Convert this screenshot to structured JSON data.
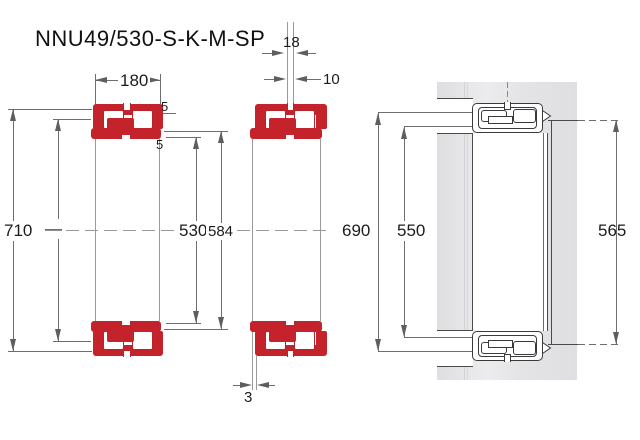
{
  "title": "NNU49/530-S-K-M-SP",
  "front_view": {
    "dim_width": "180",
    "dim_outer_diameter": "710",
    "dim_unlabeled": "—",
    "dim_bore": "530",
    "dim_raceway": "584",
    "dim_flange_top": "5",
    "dim_flange_bottom": "5"
  },
  "offset_view": {
    "dim_groove_width": "18",
    "dim_hole_diameter": "10",
    "dim_axial_offset": "3"
  },
  "mounted_view": {
    "dim_housing_abutment": "690",
    "dim_shaft_abutment": "550",
    "dim_sleeve_diameter": "565"
  },
  "colors": {
    "bearing_red": "#c4232b",
    "dimension_gray": "#6e6e6e",
    "drawing_dark": "#3a3a3a",
    "housing_gray": "#e6e6e8"
  }
}
